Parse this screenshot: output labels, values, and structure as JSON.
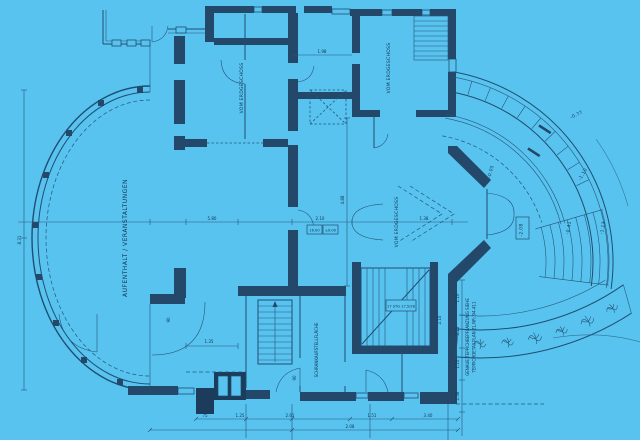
{
  "meta": {
    "kind": "architectural floor plan blueprint (scanned, blue paper)",
    "language": "German"
  },
  "palette": {
    "background": "#58c3ef",
    "line": "#1f4e72",
    "wall_fill": "#23486a",
    "text": "#0f3350"
  },
  "labels": {
    "aufenthalt": "AUFENTHALT / VERANSTALTUNGEN",
    "vom_erdgeschoss_1": "VOM ERDGESCHOSS",
    "vom_erdgeschoss_2": "VOM ERDGESCHOSS",
    "vom_erdgeschoss_3": "VOM ERDGESCHOSS",
    "schrank": "SCHRANKAUFSTELLFLÄCHE",
    "teppich_line1": "GENAUE TEPPICHBEPFLANZUNG SIEHE",
    "teppich_line2": "TEPPICHDETAILPLAN ZL.NR: 94-411"
  },
  "elevations": {
    "e208": "-2.08",
    "e041": "-0.41",
    "e113": "-1.13",
    "e110": "-1.10",
    "e005": "-0.05",
    "e077": "-0.77"
  },
  "stair": {
    "label": "17 STG 17,5/28"
  },
  "dims": [
    "8.31",
    "5.80",
    "2.10",
    "1.38",
    "1.98",
    "4.88",
    "1.35",
    "90",
    "90",
    "2.10",
    "1.10",
    "2.38",
    "1.10",
    "2.38",
    "1.25",
    "2.61",
    "16.00",
    "±0.00",
    "1.51",
    "3.40",
    "75",
    "2.08"
  ]
}
